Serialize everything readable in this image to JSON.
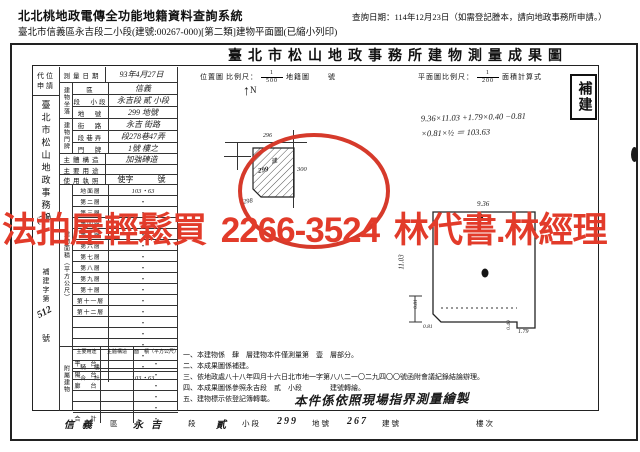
{
  "header": {
    "system_title": "北北桃地政電傳全功能地籍資料查詢系統",
    "query_date": "查詢日期：114年12月23日（如需登記謄本，請向地政事務所申請。）",
    "doc_line": "臺北市信義區永吉段二小段(建號:00267-000)[第二類]建物平面圖(已縮小列印)"
  },
  "document": {
    "title": "臺北市松山地政事務所建物測量成果圖",
    "sidebar": {
      "subrogation": "代位申請",
      "office": "臺北市松山地政事務所",
      "note": "(70)",
      "rebuild_label": "補建字第",
      "rebuild_no": "512",
      "rebuild_suffix": "號"
    },
    "table": {
      "survey_date": {
        "label": "測量日期",
        "value": "93年4月27日"
      },
      "location_group": {
        "label": "建物坐落",
        "rows": [
          {
            "label": "區",
            "value": "信義"
          },
          {
            "label": "段　小段",
            "value": "永吉段 貳 小段"
          },
          {
            "label": "地　號",
            "value": "299 地號"
          }
        ]
      },
      "address_group": {
        "label": "建物門牌",
        "rows": [
          {
            "label": "街　路",
            "value": "永吉 街路"
          },
          {
            "label": "段巷弄",
            "value": "段278巷47弄"
          },
          {
            "label": "門　牌",
            "value": "1號 樓之"
          }
        ]
      },
      "structure": {
        "label": "主體構造",
        "value": "加強磚造"
      },
      "usage": {
        "label": "主要用途",
        "value": ""
      },
      "license": {
        "label": "使用執照",
        "value": "使字　　　號"
      },
      "area_group": {
        "label": "建物面積（平方公尺）",
        "rows": [
          {
            "label": "地面層",
            "value": "103・63",
            "hw": true
          },
          {
            "label": "第二層",
            "value": "・"
          },
          {
            "label": "第三層",
            "value": "・"
          },
          {
            "label": "第四層",
            "value": "・"
          },
          {
            "label": "第五層",
            "value": "・"
          },
          {
            "label": "第六層",
            "value": "・"
          },
          {
            "label": "第七層",
            "value": "・"
          },
          {
            "label": "第八層",
            "value": "・"
          },
          {
            "label": "第九層",
            "value": "・"
          },
          {
            "label": "第十層",
            "value": "・"
          },
          {
            "label": "第十一層",
            "value": "・"
          },
          {
            "label": "第十二層",
            "value": "・"
          },
          {
            "label": "",
            "value": "・"
          },
          {
            "label": "",
            "value": "・"
          },
          {
            "label": "",
            "value": "・"
          },
          {
            "label": "",
            "value": "・"
          },
          {
            "label": "騎　樓",
            "value": "・"
          },
          {
            "label": "合　計",
            "value": "103・63",
            "hw": true
          }
        ]
      },
      "annex_group": {
        "label": "附屬建物",
        "headers": [
          "主要用途",
          "主體構造",
          "面　積（平方公尺）"
        ],
        "rows": [
          {
            "use": "平　台",
            "structure": "",
            "area": "・"
          },
          {
            "use": "陽　台",
            "structure": "",
            "area": "・"
          },
          {
            "use": "廊　台",
            "structure": "",
            "area": "・"
          },
          {
            "use": "",
            "structure": "",
            "area": "・"
          },
          {
            "use": "",
            "structure": "",
            "area": "・"
          },
          {
            "use": "合　計",
            "structure": "",
            "area": "・"
          }
        ]
      }
    },
    "scale_bar": {
      "location_label": "位置圖",
      "scale_prefix": "比例尺：",
      "loc_num": "1",
      "loc_den": "500",
      "cadastral_label": "地籍圖",
      "no_label": "號",
      "plan_scale_label": "平面圖比例尺：",
      "plan_num": "1",
      "plan_den": "200",
      "calc_title": "面積計算式"
    },
    "location_sketch": {
      "north": "N",
      "north_arrow": "↑",
      "n296": "296",
      "n300": "300",
      "n298": "298",
      "parcel_char": "建",
      "parcel_no": "299",
      "circle_color": "#d63a2b"
    },
    "plan": {
      "calc1": "9.36×11.03 +1.79×0.40 −0.81",
      "calc2": "×0.81×½ ＝ 103.63",
      "dim_top": "9.36",
      "dim_left": "11.03",
      "chamfer_v": "0.81",
      "chamfer_h": "0.81",
      "notch_v": "0.40",
      "notch_h": "1.79"
    },
    "stamp": "補建",
    "notes": [
      "一、本建物係　肆　層建物本件僅測量第　壹　層部分。",
      "二、本成果圖係補建。",
      "三、依地政處八十八年四月十六日北市地一字第八八二一〇二九四〇〇號函附會議紀錄結論辦理。",
      "四、本成果圖係參照永吉段　貳　小段　　　　建號轉繪。",
      "五、建物標示依登記簿轉載。"
    ],
    "notes_overlay": "本件係依照現場指界測量繪製",
    "bottom_strip": {
      "district_value": "信義",
      "district_label": "區",
      "street_value": "永吉",
      "section_label": "段",
      "subsection_value": "貳",
      "subsection_label": "小段",
      "parcel_value": "299",
      "parcel_label": "地號",
      "building_value": "267",
      "building_label": "建號",
      "floor_label": "樓次"
    }
  },
  "overlay": {
    "ad_text": "法拍屋輕鬆買 2266-3524 林代書.林經理",
    "color": "#e23b2a"
  }
}
